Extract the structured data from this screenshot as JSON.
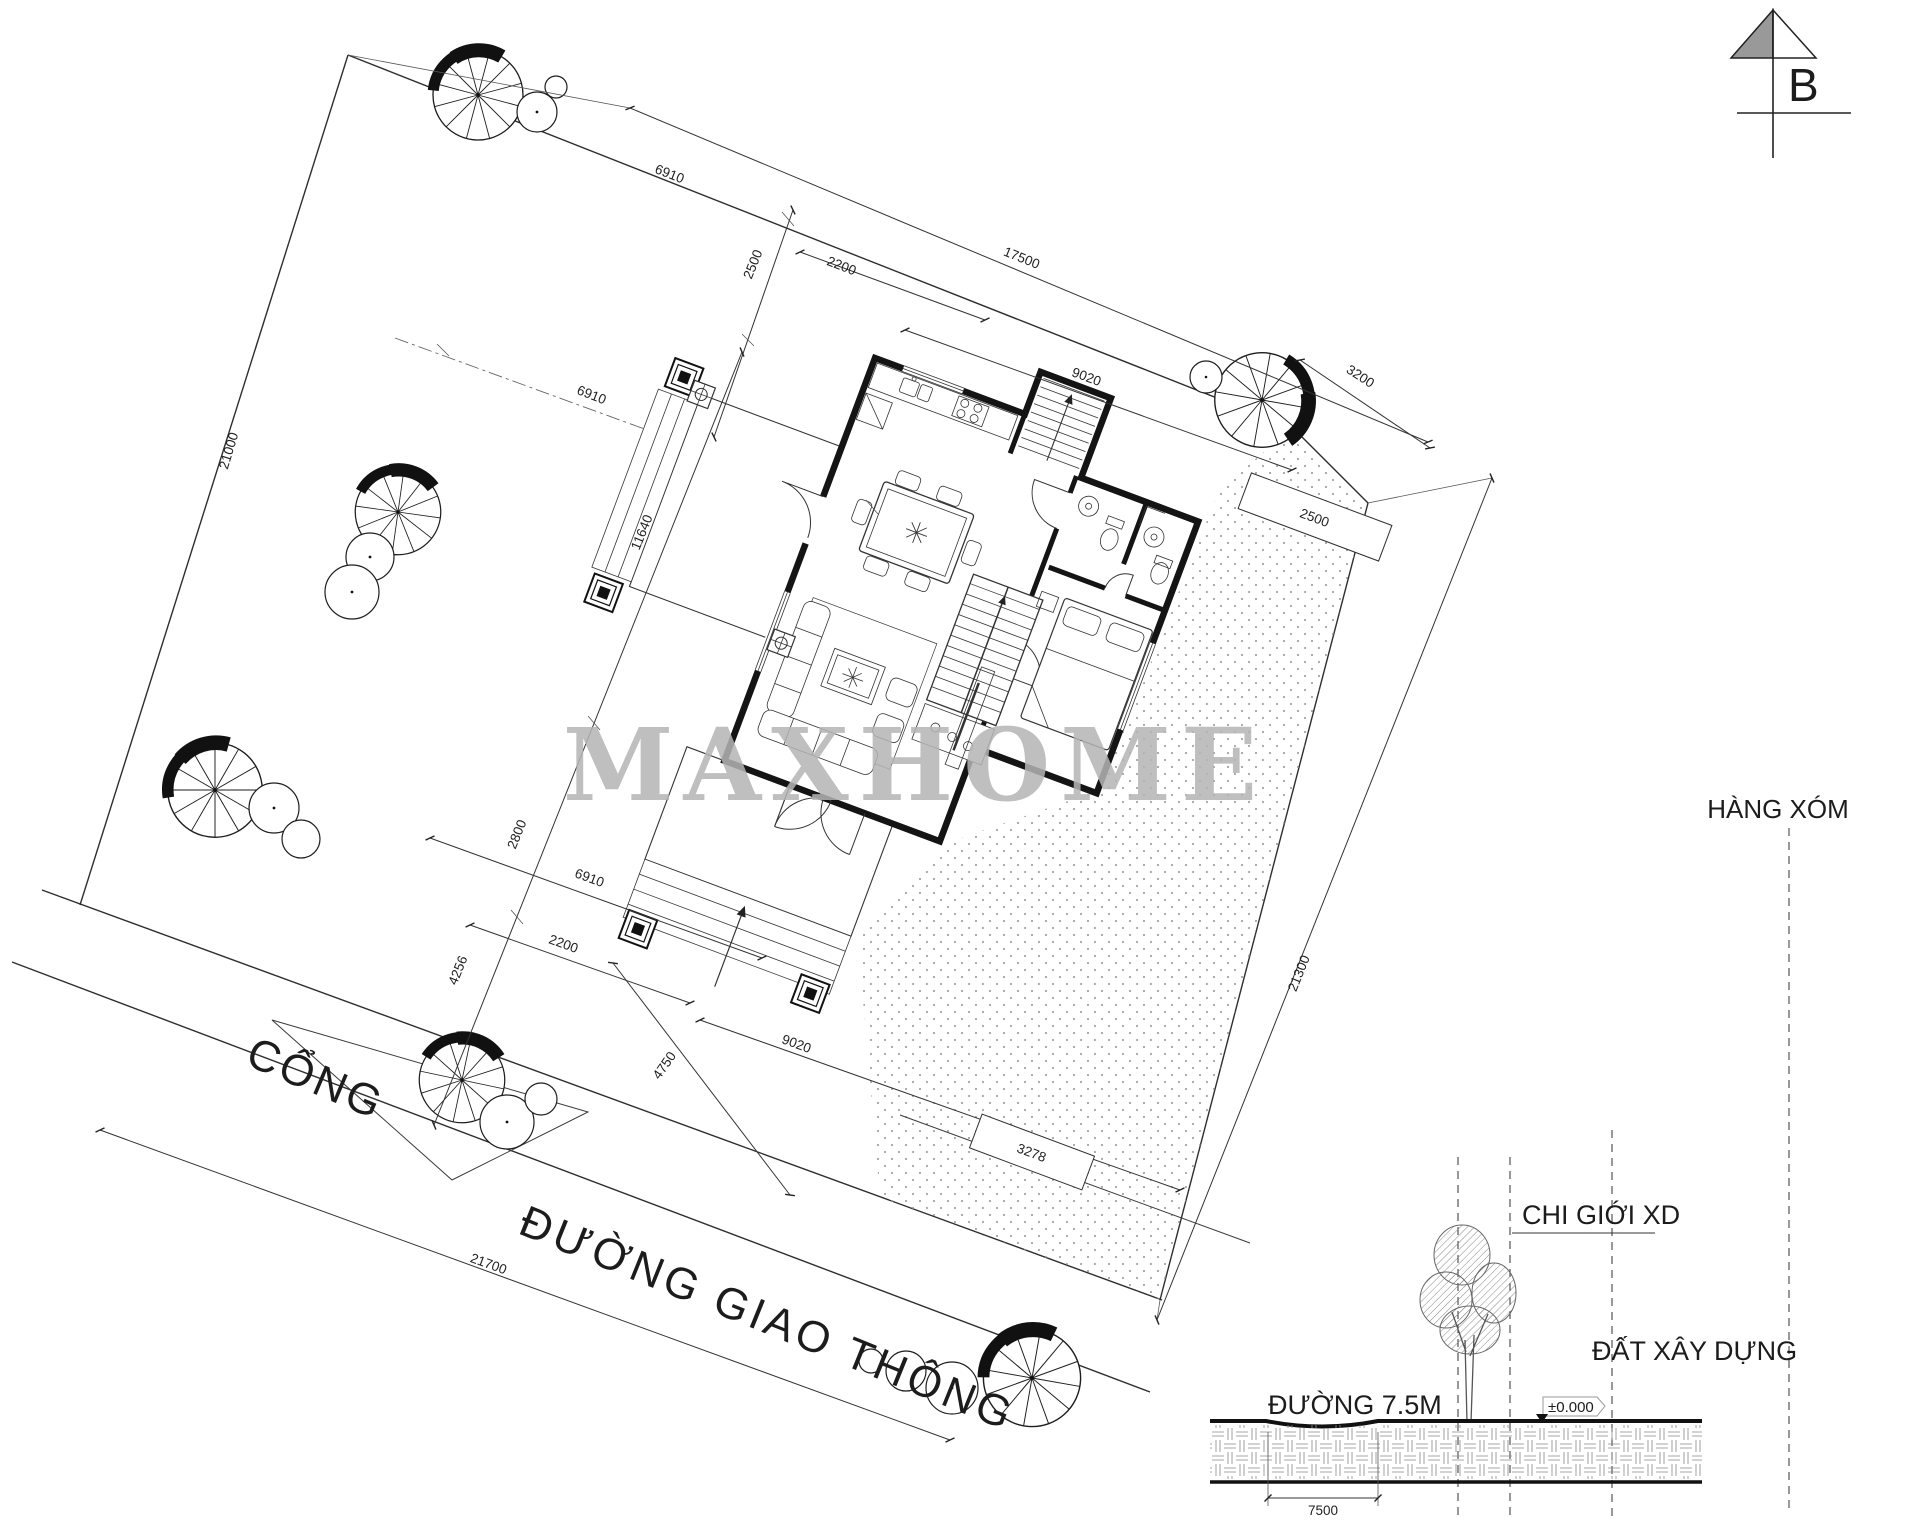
{
  "north_arrow": {
    "label": "B"
  },
  "watermark": "MAXHOME",
  "plan": {
    "gate_label": "CỔNG",
    "road_label": "ĐƯỜNG GIAO THÔNG",
    "neighbor_label": "HÀNG XÓM",
    "dims": {
      "plot_top_total": "17500",
      "plot_top_left": "6910",
      "setback_top": "2500",
      "top_seg": "2200",
      "house_top_width": "9020",
      "corner_cut": "3200",
      "east_strip": "2500",
      "plot_left_total": "21000",
      "lot_mid": "6910",
      "house_side_depth": "11640",
      "side_seg": "2800",
      "lower_left": "6910",
      "lower_seg": "2200",
      "front_seg": "4256",
      "front_setback": "4750",
      "house_bottom_width": "9020",
      "road_frontage_total": "21700",
      "east_gap": "3278",
      "plot_right_total": "21300"
    }
  },
  "section": {
    "boundary_label": "CHI GIỚI XD",
    "land_label": "ĐẤT XÂY DỰNG",
    "road_label": "ĐƯỜNG 7.5M",
    "level_label": "±0.000",
    "road_width": "7500"
  }
}
